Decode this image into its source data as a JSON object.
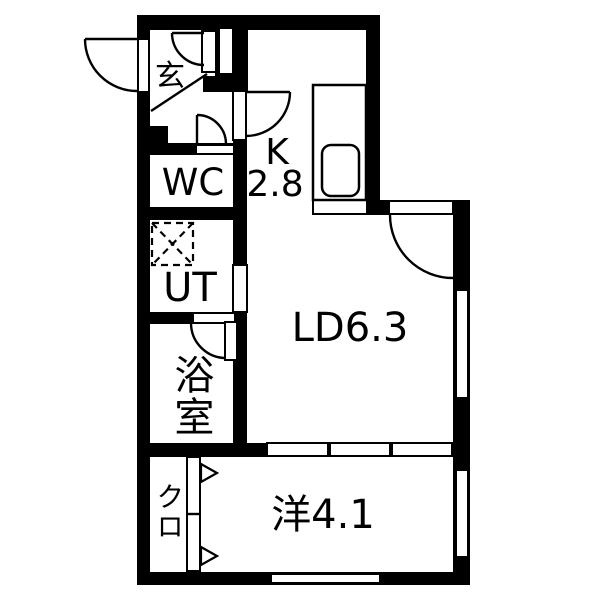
{
  "plan_title": "apartment-floor-plan",
  "rooms": {
    "genkan": {
      "label": "玄"
    },
    "wc": {
      "label": "WC"
    },
    "ut": {
      "label": "UT"
    },
    "bath": {
      "label": "浴室"
    },
    "kitchen": {
      "label": "K",
      "area": "2.8"
    },
    "living": {
      "label": "LD6.3"
    },
    "bedroom": {
      "label": "洋4.1"
    },
    "closet": {
      "label": "クロ"
    }
  },
  "colors": {
    "wall": "#000000",
    "floor": "#ffffff",
    "line": "#000000"
  },
  "fixtures": {
    "washing_machine_pan": "dashed-square-with-x",
    "kitchen_sink": "rounded-rect-sink",
    "kitchen_counter": "counter-with-pass-through",
    "swing_door_count": 6,
    "sliding_panel_count": 3,
    "closet_folding_door": "two-panel-with-arrows",
    "window_count": 3
  }
}
